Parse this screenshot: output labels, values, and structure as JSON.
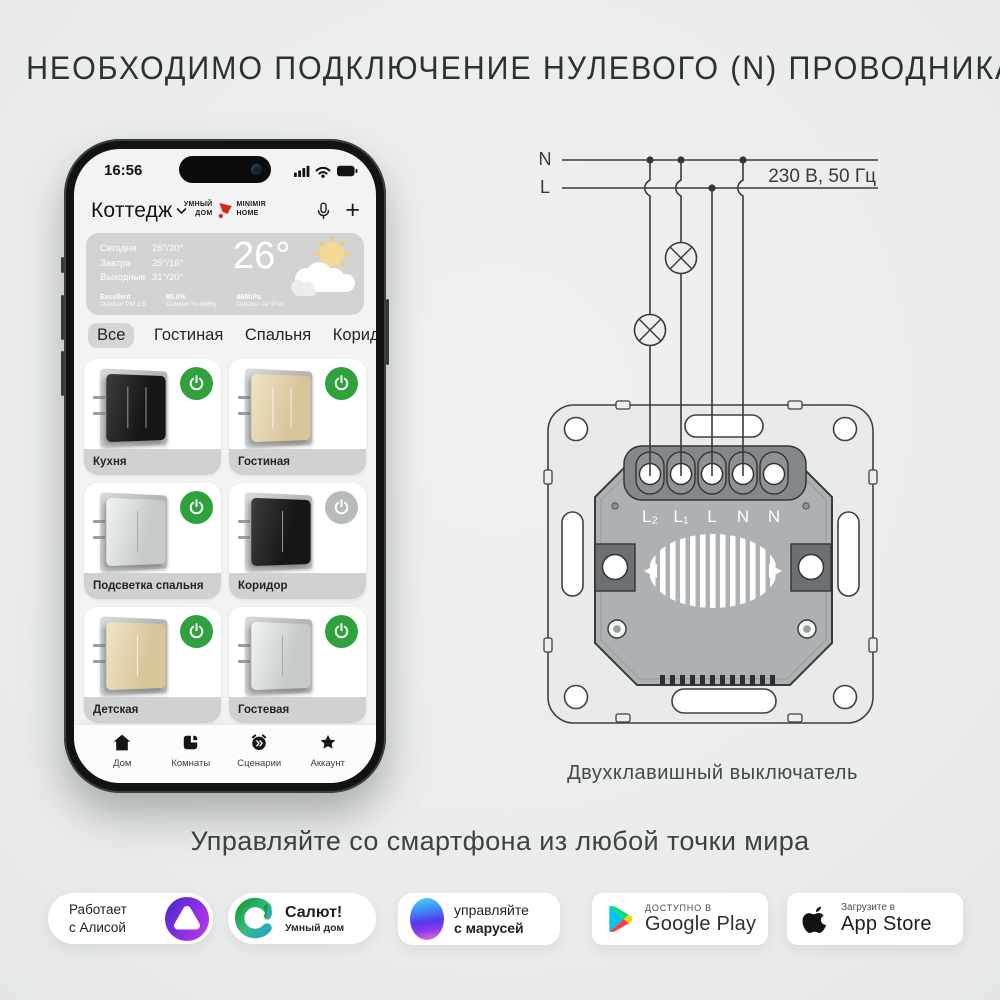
{
  "page": {
    "top_heading": "НЕОБХОДИМО ПОДКЛЮЧЕНИЕ НУЛЕВОГО (N) ПРОВОДНИКА",
    "bottom_heading": "Управляйте со смартфона из любой точки мира"
  },
  "colors": {
    "background": "#eceeed",
    "accent_green": "#2fa23e",
    "toggle_off_gray": "#b7bbb9",
    "brand_red": "#d9291f",
    "diagram_line": "#3a3a3a"
  },
  "phone": {
    "status": {
      "time": "16:56"
    },
    "header": {
      "home": "Коттедж",
      "brand_left_top": "УМНЫЙ",
      "brand_left_bottom": "ДОМ",
      "brand_right_top": "MINIMIR",
      "brand_right_bottom": "HOME",
      "plus": "+"
    },
    "weather": {
      "forecast": [
        {
          "label": "Сегодня",
          "value": "26°/20°"
        },
        {
          "label": "Завтра",
          "value": "25°/16°"
        },
        {
          "label": "Выходные",
          "value": "31°/20°"
        }
      ],
      "big_temp": "26°",
      "stats": [
        {
          "value": "Excellent",
          "label": "Outdoor PM 2.5"
        },
        {
          "value": "85.0%",
          "label": "Outdoor Humidity"
        },
        {
          "value": "968hPa",
          "label": "Outdoor Air Pres"
        }
      ]
    },
    "tabs": [
      {
        "label": "Все"
      },
      {
        "label": "Гостиная"
      },
      {
        "label": "Спальня"
      },
      {
        "label": "Коридор"
      }
    ],
    "cards": [
      {
        "label": "Кухня",
        "state": "on"
      },
      {
        "label": "Гостиная",
        "state": "on"
      },
      {
        "label": "Подсветка спальня",
        "state": "on"
      },
      {
        "label": "Коридор",
        "state": "off"
      },
      {
        "label": "Детская",
        "state": "on"
      },
      {
        "label": "Гостевая",
        "state": "on"
      }
    ],
    "nav": [
      {
        "label": "Дом"
      },
      {
        "label": "Комнаты"
      },
      {
        "label": "Сценарии"
      },
      {
        "label": "Аккаунт"
      }
    ]
  },
  "diagram": {
    "n": "N",
    "l": "L",
    "voltage": "230 В, 50 Гц",
    "terminals": [
      "L₂",
      "L₁",
      "L",
      "N",
      "N"
    ],
    "caption": "Двухклавишный выключатель"
  },
  "badges": {
    "alice": {
      "line1": "Работает",
      "line2": "с Алисой"
    },
    "salut": {
      "line1": "Салют!",
      "line2": "Умный дом"
    },
    "marusya": {
      "line1": "управляйте",
      "line2": "с марусей"
    },
    "gplay": {
      "line1": "ДОСТУПНО В",
      "line2": "Google Play"
    },
    "appstore": {
      "line1": "Загрузите в",
      "line2": "App Store"
    }
  }
}
